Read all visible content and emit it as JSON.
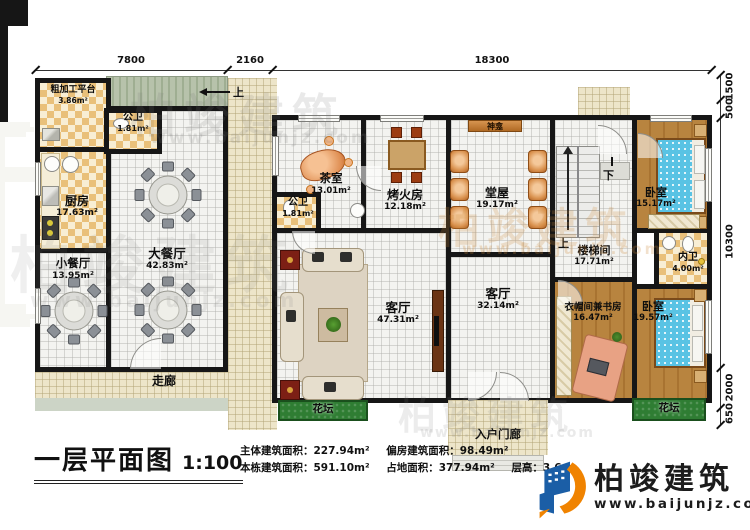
{
  "plan": {
    "title": "一层平面图",
    "scale": "1:100",
    "stats_row1": [
      "主体建筑面积：227.94m²",
      "偏房建筑面积：98.49m²"
    ],
    "stats_row2": [
      "本栋建筑面积：591.10m²",
      "占地面积：377.94m²",
      "层高：3.6m"
    ]
  },
  "dimensions": {
    "top": [
      "7800",
      "2160",
      "18300"
    ],
    "right": [
      "1500",
      "500",
      "10300",
      "2000",
      "650"
    ]
  },
  "rooms": {
    "rough_platform": {
      "name": "粗加工平台",
      "area": "3.86m²"
    },
    "bath_left": {
      "name": "公卫",
      "area": "1.81m²"
    },
    "kitchen": {
      "name": "厨房",
      "area": "17.63m²"
    },
    "small_dining": {
      "name": "小餐厅",
      "area": "13.95m²"
    },
    "big_dining": {
      "name": "大餐厅",
      "area": "42.83m²"
    },
    "corridor": {
      "name": "走廊"
    },
    "tea_room": {
      "name": "茶室",
      "area": "13.01m²"
    },
    "bath_main": {
      "name": "公卫",
      "area": "1.81m²"
    },
    "fire_room": {
      "name": "烤火房",
      "area": "12.18m²"
    },
    "hall": {
      "name": "堂屋",
      "area": "19.17m²"
    },
    "shrine": {
      "name": "神龛"
    },
    "stairwell": {
      "name": "楼梯间",
      "area": "17.71m²"
    },
    "bedroom_top": {
      "name": "卧室",
      "area": "15.17m²"
    },
    "inner_bath": {
      "name": "内卫",
      "area": "4.00m²"
    },
    "study": {
      "name": "衣帽间兼书房",
      "area": "16.47m²"
    },
    "bedroom_bottom": {
      "name": "卧室",
      "area": "19.57m²"
    },
    "living_main": {
      "name": "客厅",
      "area": "47.31m²"
    },
    "living_second": {
      "name": "客厅",
      "area": "32.14m²"
    },
    "flowerbed_left": {
      "name": "花坛"
    },
    "flowerbed_right": {
      "name": "花坛"
    },
    "porch": {
      "name": "入户门廊"
    }
  },
  "markers": {
    "up": "上",
    "down": "下"
  },
  "logo": {
    "name": "柏竣建筑",
    "url": "www.baijunjz.com"
  },
  "watermark": {
    "name": "柏竣建筑",
    "url": "www.baijunjz.com"
  },
  "colors": {
    "wall": "#161616",
    "checker_floor": "#e9c07a",
    "wood_floor": "#b8843f",
    "grass": "#2f7d33",
    "shrine_bar": "#c07a30",
    "bed": "#5bc4e4",
    "logo_blue": "#1b5ea6",
    "logo_orange": "#f08300"
  }
}
